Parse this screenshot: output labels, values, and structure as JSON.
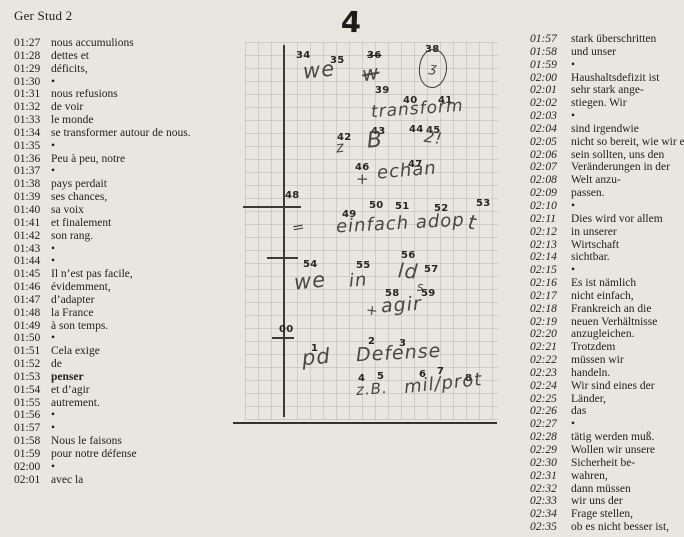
{
  "header": {
    "title": "Ger Stud 2"
  },
  "colors": {
    "paper": "#e9e6e1",
    "ink": "#23221f",
    "note_line": "#3b3a37"
  },
  "left_column": {
    "entries": [
      [
        "01:27",
        "nous accumulions"
      ],
      [
        "01:28",
        "dettes et"
      ],
      [
        "01:29",
        "déficits,"
      ],
      [
        "01:30",
        "•"
      ],
      [
        "01:31",
        "nous refusions"
      ],
      [
        "01:32",
        "de voir"
      ],
      [
        "01:33",
        "le monde"
      ],
      [
        "01:34",
        "se transformer autour de nous."
      ],
      [
        "01:35",
        "•"
      ],
      [
        "01:36",
        "Peu à peu, notre"
      ],
      [
        "01:37",
        "•"
      ],
      [
        "01:38",
        "pays perdait"
      ],
      [
        "01:39",
        "ses chances,"
      ],
      [
        "01:40",
        "sa voix"
      ],
      [
        "01:41",
        "et finalement"
      ],
      [
        "01:42",
        "son rang."
      ],
      [
        "01:43",
        "•"
      ],
      [
        "01:44",
        "•"
      ],
      [
        "01:45",
        "Il n’est pas facile,"
      ],
      [
        "01:46",
        "évidemment,"
      ],
      [
        "01:47",
        "d’adapter"
      ],
      [
        "01:48",
        "la France"
      ],
      [
        "01:49",
        "à son temps."
      ],
      [
        "01:50",
        "•"
      ],
      [
        "01:51",
        "Cela exige"
      ],
      [
        "01:52",
        "de"
      ],
      [
        "01:53",
        "penser",
        "b"
      ],
      [
        "01:54",
        "et d’agir"
      ],
      [
        "01:55",
        "autrement."
      ],
      [
        "01:56",
        "•"
      ],
      [
        "01:57",
        "•"
      ],
      [
        "01:58",
        "Nous le faisons"
      ],
      [
        "01:59",
        "pour notre défense"
      ],
      [
        "02:00",
        "•"
      ],
      [
        "02:01",
        "avec la"
      ]
    ]
  },
  "right_column": {
    "entries": [
      [
        "01:57",
        "stark überschritten"
      ],
      [
        "01:58",
        "und unser"
      ],
      [
        "01:59",
        "•"
      ],
      [
        "02:00",
        "Haushaltsdefizit ist"
      ],
      [
        "02:01",
        "sehr stark ange-"
      ],
      [
        "02:02",
        "stiegen. Wir"
      ],
      [
        "02:03",
        "•"
      ],
      [
        "02:04",
        "sind irgendwie"
      ],
      [
        "02:05",
        "nicht so bereit, wie wir es"
      ],
      [
        "02:06",
        "sein sollten, uns den"
      ],
      [
        "02:07",
        "Veränderungen in der"
      ],
      [
        "02:08",
        "Welt anzu-"
      ],
      [
        "02:09",
        "passen."
      ],
      [
        "02:10",
        "•"
      ],
      [
        "02:11",
        "Dies wird vor allem"
      ],
      [
        "02:12",
        "in unserer"
      ],
      [
        "02:13",
        "Wirtschaft"
      ],
      [
        "02:14",
        "sichtbar."
      ],
      [
        "02:15",
        "•"
      ],
      [
        "02:16",
        "Es ist nämlich"
      ],
      [
        "02:17",
        "nicht einfach,"
      ],
      [
        "02:18",
        "Frankreich an die"
      ],
      [
        "02:19",
        "neuen Verhältnisse"
      ],
      [
        "02:20",
        "anzugleichen."
      ],
      [
        "02:21",
        "Trotzdem"
      ],
      [
        "02:22",
        "müssen wir"
      ],
      [
        "02:23",
        "handeln."
      ],
      [
        "02:24",
        "Wir sind eines der"
      ],
      [
        "02:25",
        "Länder,"
      ],
      [
        "02:26",
        "das"
      ],
      [
        "02:27",
        "•"
      ],
      [
        "02:28",
        "tätig werden muß."
      ],
      [
        "02:29",
        "Wollen wir unsere"
      ],
      [
        "02:30",
        "Sicherheit be-"
      ],
      [
        "02:31",
        "wahren,"
      ],
      [
        "02:32",
        "dann müssen"
      ],
      [
        "02:33",
        "wir uns der"
      ],
      [
        "02:34",
        "Frage stellen,"
      ],
      [
        "02:35",
        "ob es nicht besser ist,"
      ]
    ]
  },
  "note": {
    "page_number": "4",
    "items": [
      {
        "id": "n34",
        "text": "34",
        "kind": "num"
      },
      {
        "id": "n35",
        "text": "35",
        "kind": "num"
      },
      {
        "id": "n36",
        "text": "36",
        "kind": "numstrike"
      },
      {
        "id": "n38",
        "text": "38",
        "kind": "num"
      },
      {
        "id": "n39",
        "text": "39",
        "kind": "num"
      },
      {
        "id": "n40",
        "text": "40",
        "kind": "num"
      },
      {
        "id": "n41",
        "text": "41",
        "kind": "num"
      },
      {
        "id": "n42",
        "text": "42",
        "kind": "num"
      },
      {
        "id": "n43",
        "text": "43",
        "kind": "num"
      },
      {
        "id": "n44",
        "text": "44",
        "kind": "num"
      },
      {
        "id": "n45",
        "text": "45",
        "kind": "num"
      },
      {
        "id": "n46",
        "text": "46",
        "kind": "num"
      },
      {
        "id": "n47",
        "text": "47",
        "kind": "num"
      },
      {
        "id": "n48",
        "text": "48",
        "kind": "num"
      },
      {
        "id": "n49",
        "text": "49",
        "kind": "num"
      },
      {
        "id": "n50",
        "text": "50",
        "kind": "num"
      },
      {
        "id": "n51",
        "text": "51",
        "kind": "num"
      },
      {
        "id": "n52",
        "text": "52",
        "kind": "num"
      },
      {
        "id": "n53",
        "text": "53",
        "kind": "num"
      },
      {
        "id": "n54",
        "text": "54",
        "kind": "num"
      },
      {
        "id": "n55",
        "text": "55",
        "kind": "num"
      },
      {
        "id": "n56",
        "text": "56",
        "kind": "num"
      },
      {
        "id": "n57",
        "text": "57",
        "kind": "num"
      },
      {
        "id": "n58",
        "text": "58",
        "kind": "num"
      },
      {
        "id": "n59",
        "text": "59",
        "kind": "num"
      },
      {
        "id": "n00",
        "text": "00",
        "kind": "num"
      },
      {
        "id": "n1",
        "text": "1",
        "kind": "num"
      },
      {
        "id": "n2",
        "text": "2",
        "kind": "num"
      },
      {
        "id": "n3",
        "text": "3",
        "kind": "num"
      },
      {
        "id": "n4",
        "text": "4",
        "kind": "num"
      },
      {
        "id": "n5",
        "text": "5",
        "kind": "num"
      },
      {
        "id": "n6",
        "text": "6",
        "kind": "num"
      },
      {
        "id": "n7",
        "text": "7",
        "kind": "num"
      },
      {
        "id": "n8",
        "text": "8",
        "kind": "num"
      },
      {
        "id": "we1",
        "text": "we",
        "kind": "hand"
      },
      {
        "id": "crossed-word",
        "text": "w",
        "kind": "strike"
      },
      {
        "id": "circled-mark",
        "text": "ʒ",
        "kind": "circle"
      },
      {
        "id": "transform",
        "text": "transform",
        "kind": "hand"
      },
      {
        "id": "z",
        "text": "z",
        "kind": "hand"
      },
      {
        "id": "B",
        "text": "B",
        "kind": "hand"
      },
      {
        "id": "two-excl",
        "text": "2!",
        "kind": "hand"
      },
      {
        "id": "plus1",
        "text": "+",
        "kind": "hand"
      },
      {
        "id": "echan",
        "text": "echan",
        "kind": "hand"
      },
      {
        "id": "equals",
        "text": "=",
        "kind": "hand"
      },
      {
        "id": "einfach-adop",
        "text": "einfach adop",
        "kind": "hand"
      },
      {
        "id": "t-stroke",
        "text": "t",
        "kind": "hand"
      },
      {
        "id": "we2",
        "text": "we",
        "kind": "hand"
      },
      {
        "id": "in",
        "text": "in",
        "kind": "hand"
      },
      {
        "id": "ld",
        "text": "ld",
        "kind": "hand"
      },
      {
        "id": "s-sub",
        "text": "s",
        "kind": "hand"
      },
      {
        "id": "plus2",
        "text": "+",
        "kind": "hand"
      },
      {
        "id": "agir",
        "text": "agir",
        "kind": "hand"
      },
      {
        "id": "pd",
        "text": "pd",
        "kind": "hand"
      },
      {
        "id": "defense",
        "text": "Defense",
        "kind": "hand"
      },
      {
        "id": "zb",
        "text": "z.B.",
        "kind": "hand"
      },
      {
        "id": "milprot",
        "text": "mil/prot",
        "kind": "hand"
      }
    ]
  }
}
